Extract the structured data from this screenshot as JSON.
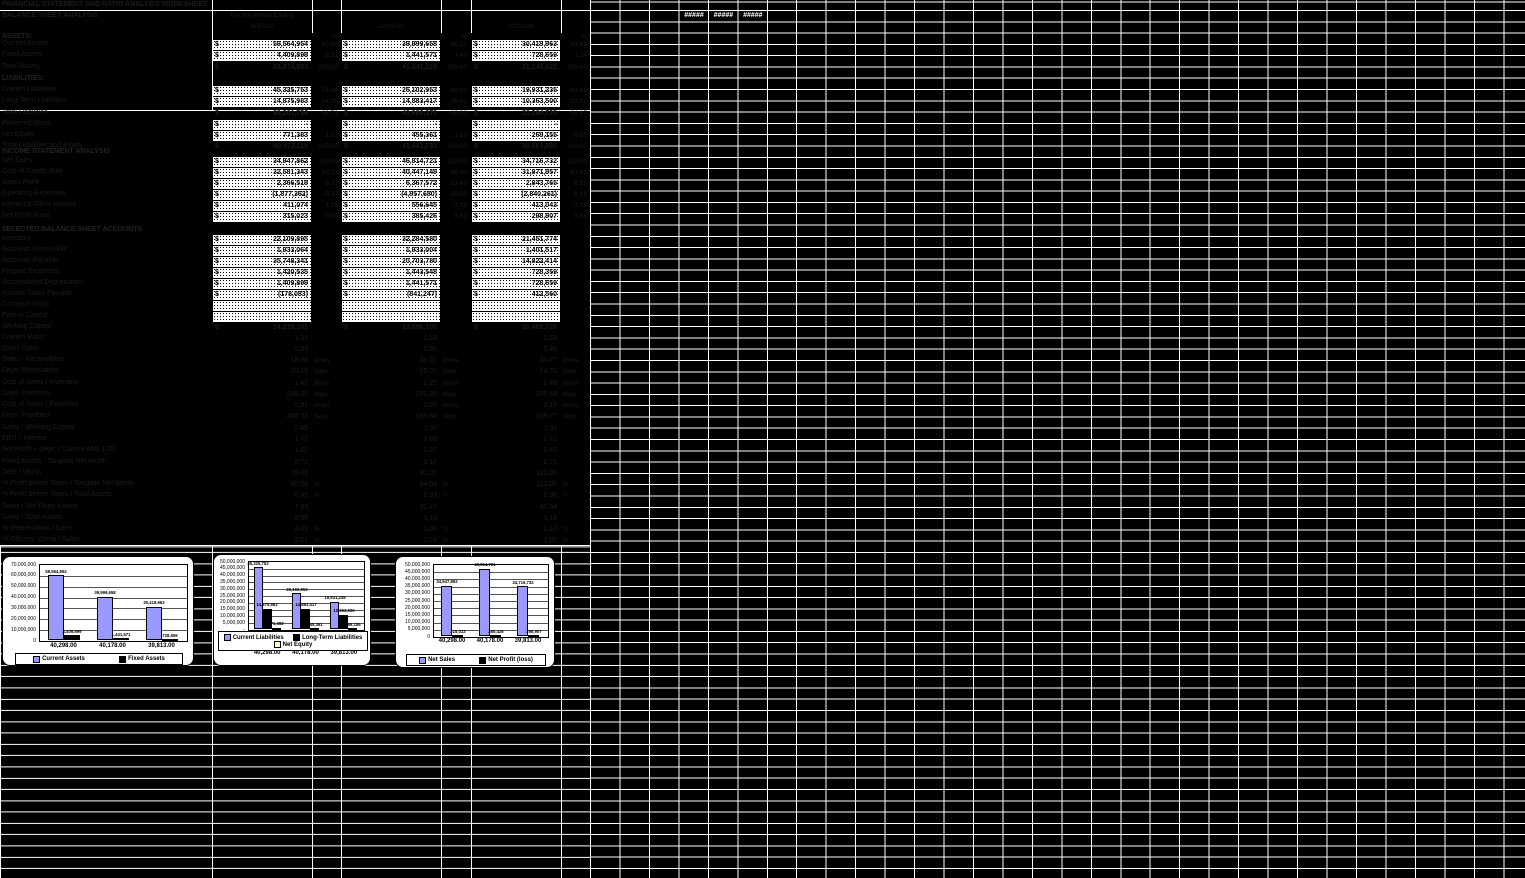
{
  "sheet": {
    "title": "FINANCIAL STATEMENT AND RATIO ANALYSIS WORKSHEET",
    "section_balance": "BALANCE SHEET ANALYSIS",
    "header": {
      "note": "For the Period Ending",
      "col_b_date": "4/30/10",
      "col_d_date": "12/31/09",
      "col_f_date": "12/31/08",
      "pct": "%"
    },
    "overflow_cells": [
      "#####",
      "#####",
      "#####"
    ],
    "rows": [
      {
        "y": 33,
        "style": "label",
        "label": "ASSETS:"
      },
      {
        "y": 40,
        "style": "white",
        "label": "Current Assets",
        "b": "59,564,954",
        "bp": "92.60",
        "d": "39,999,658",
        "dp": "96.22",
        "f": "30,419,963",
        "fp": "92.61"
      },
      {
        "y": 51,
        "style": "white",
        "label": "Fixed Assets",
        "b": "4,409,899",
        "bp": "2.31",
        "d": "1,441,571",
        "dp": "3.49",
        "f": "728,659",
        "fp": "2.24"
      },
      {
        "y": 63,
        "style": "dark$",
        "label": "Total Assets",
        "b": "63,974,853",
        "bp": "100.00",
        "d": "41,441,229",
        "dp": "100.00",
        "f": "31,148,622",
        "fp": "100.00"
      },
      {
        "y": 75,
        "style": "label",
        "label": "LIABILITIES:"
      },
      {
        "y": 86,
        "style": "white",
        "label": "Current Liabilities",
        "b": "45,325,753",
        "bp": "74.34",
        "d": "26,102,953",
        "dp": "62.09",
        "f": "19,931,235",
        "fp": "61.05"
      },
      {
        "y": 97,
        "style": "white",
        "label": "Long-Term Liabilities",
        "b": "14,875,983",
        "bp": "24.39",
        "d": "14,883,417",
        "dp": "35.91",
        "f": "10,363,500",
        "fp": "33.12"
      },
      {
        "y": 109,
        "style": "dark$",
        "label": "Total Liabilities",
        "b": "60,201,736",
        "bp": "98.73",
        "d": "40,986,370",
        "dp": "98.00",
        "f": "30,294,735",
        "fp": "94.17"
      },
      {
        "y": 120,
        "style": "white",
        "label": "Preferred Stock",
        "b": "-",
        "d": "-",
        "f": "-"
      },
      {
        "y": 131,
        "style": "white",
        "label": "Net Equity",
        "b": "771,383",
        "bp": "1.27",
        "d": "455,361",
        "dp": "1.10",
        "f": "269,155",
        "fp": "0.88"
      },
      {
        "y": 142,
        "style": "dark$",
        "label": "Total Liabilities and Equity",
        "b": "60,973,119",
        "bp": "100.00",
        "d": "41,441,731",
        "dp": "100.00",
        "f": "30,563,890",
        "fp": "100.00"
      },
      {
        "y": 148,
        "style": "header",
        "label": "INCOME STATEMENT ANALYSIS"
      },
      {
        "y": 157,
        "style": "white",
        "label": "Net Sales",
        "b": "34,947,862",
        "bp": "100.00",
        "d": "46,814,721",
        "dp": "100.00",
        "f": "34,716,732",
        "fp": "100.00"
      },
      {
        "y": 168,
        "style": "white",
        "label": "Cost of Goods Sold",
        "b": "32,581,343",
        "bp": "93.23",
        "d": "40,447,149",
        "dp": "86.40",
        "f": "31,871,957",
        "fp": "91.81"
      },
      {
        "y": 179,
        "style": "white",
        "label": "Gross Profit",
        "b": "2,366,519",
        "bp": "6.77",
        "d": "6,367,572",
        "dp": "13.60",
        "f": "2,843,765",
        "fp": "8.19"
      },
      {
        "y": 190,
        "style": "white",
        "label": "Operating Expenses",
        "b": "(1,877,362)",
        "bp": "-5.37",
        "d": "(4,957,680)",
        "dp": "-10.59",
        "f": "(2,840,261)",
        "fp": "-8.18"
      },
      {
        "y": 201,
        "style": "white",
        "label": "Interest & Other Income",
        "b": "411,074",
        "bp": "1.18",
        "d": "556,645",
        "dp": "1.19",
        "f": "413,043",
        "fp": "1.19"
      },
      {
        "y": 212,
        "style": "white",
        "label": "Net Profit (loss)",
        "b": "315,023",
        "bp": "0.90",
        "d": "385,426",
        "dp": "0.82",
        "f": "298,907",
        "fp": "0.86"
      },
      {
        "y": 226,
        "style": "header",
        "label": "SELECTED BALANCE SHEET ACCOUNTS"
      },
      {
        "y": 235,
        "style": "white",
        "label": "Inventory",
        "b": "22,109,895",
        "d": "32,284,580",
        "f": "21,451,774"
      },
      {
        "y": 246,
        "style": "white",
        "label": "Accounts Receivable",
        "b": "1,933,064",
        "d": "1,933,004",
        "f": "1,401,517"
      },
      {
        "y": 257,
        "style": "white",
        "label": "Accounts Payable",
        "b": "35,748,341",
        "d": "20,703,780",
        "f": "14,822,414"
      },
      {
        "y": 268,
        "style": "white",
        "label": "Prepaid Expenses",
        "b": "1,420,535",
        "d": "1,443,548",
        "f": "728,359"
      },
      {
        "y": 279,
        "style": "white",
        "label": "Accumulated Depreciation",
        "b": "1,409,899",
        "d": "1,441,571",
        "f": "728,659"
      },
      {
        "y": 290,
        "style": "white",
        "label": "Income Taxes Payable",
        "b": "(178,083)",
        "d": "(841,247)",
        "f": "412,560"
      },
      {
        "y": 301,
        "style": "white",
        "label": "Common Stock",
        "b": "",
        "d": "",
        "f": ""
      },
      {
        "y": 312,
        "style": "white",
        "label": "Paid-in Capital",
        "b": "",
        "d": "",
        "f": ""
      },
      {
        "y": 323,
        "style": "dark$",
        "label": "Working Capital",
        "b": "14,239,201",
        "d": "13,896,105",
        "f": "10,488,728"
      },
      {
        "y": 334,
        "style": "ratio",
        "label": "Current Ratio",
        "b": "1.31",
        "d": "1.53",
        "f": "1.53"
      },
      {
        "y": 345,
        "style": "ratio",
        "label": "Quick Ratio",
        "b": "0.83",
        "d": "0.30",
        "f": "0.45"
      },
      {
        "y": 356,
        "style": "ratio",
        "label": "Sales / Receivables",
        "b": "18.08",
        "d": "24.22",
        "f": "24.77",
        "unit": "times"
      },
      {
        "y": 367,
        "style": "ratio",
        "label": "Days' Receivables",
        "b": "20.19",
        "d": "15.07",
        "f": "14.73",
        "unit": "days"
      },
      {
        "y": 379,
        "style": "ratio",
        "label": "Cost of Sales / Inventory",
        "b": "1.47",
        "d": "1.25",
        "f": "1.49",
        "unit": "times"
      },
      {
        "y": 390,
        "style": "ratio",
        "label": "Days' Inventory",
        "b": "248.30",
        "d": "291.35",
        "f": "245.64",
        "unit": "days"
      },
      {
        "y": 401,
        "style": "ratio",
        "label": "Cost of Sales / Payables",
        "b": "0.91",
        "d": "1.95",
        "f": "2.15",
        "unit": "times"
      },
      {
        "y": 412,
        "style": "ratio",
        "label": "Days' Payables",
        "b": "400.53",
        "d": "186.84",
        "f": "169.77",
        "unit": "days"
      },
      {
        "y": 424,
        "style": "ratio",
        "label": "Sales / Working Capital",
        "b": "2.45",
        "d": "3.37",
        "f": "3.31"
      },
      {
        "y": 435,
        "style": "ratio",
        "label": "EBIT / Interest",
        "b": "1.77",
        "d": "1.69",
        "f": "1.72"
      },
      {
        "y": 446,
        "style": "ratio",
        "label": "Net Profit + Depr. / Current Mat. LTD",
        "b": "1.22",
        "d": "1.27",
        "f": "1.41"
      },
      {
        "y": 458,
        "style": "ratio",
        "label": "Fixed Assets / Tangible Net Worth",
        "b": "5.72",
        "d": "3.17",
        "f": "2.71"
      },
      {
        "y": 469,
        "style": "ratio",
        "label": "Debt / Worth",
        "b": "78.04",
        "d": "90.01",
        "f": "112.55"
      },
      {
        "y": 480,
        "style": "ratio",
        "label": "% Profit before Taxes / Tangible Net Worth",
        "b": "40.84",
        "d": "84.64",
        "f": "111.05",
        "unit": "%"
      },
      {
        "y": 491,
        "style": "ratio",
        "label": "% Profit before Taxes / Total Assets",
        "b": "0.49",
        "d": "0.93",
        "f": "0.98",
        "unit": "%"
      },
      {
        "y": 503,
        "style": "ratio",
        "label": "Sales / Net Fixed Assets",
        "b": "7.93",
        "d": "32.47",
        "f": "47.64"
      },
      {
        "y": 514,
        "style": "ratio",
        "label": "Sales / Total Assets",
        "b": "0.55",
        "d": "1.13",
        "f": "1.14"
      },
      {
        "y": 525,
        "style": "ratio",
        "label": "% Depreciation / Sales",
        "b": "4.03",
        "d": "3.08",
        "f": "2.10",
        "unit": "%"
      },
      {
        "y": 536,
        "style": "ratio",
        "label": "% Officers' Comp / Sales",
        "b": "2.21",
        "d": "1.74",
        "f": "1.85",
        "unit": "%"
      }
    ]
  },
  "charts": [
    {
      "id": "assets",
      "type": "bar",
      "title": "",
      "categories": [
        "40,298.00",
        "40,178.00",
        "39,813.00"
      ],
      "y_max": 70000000,
      "y_ticks": [
        "70,000,000",
        "60,000,000",
        "50,000,000",
        "40,000,000",
        "30,000,000",
        "20,000,000",
        "10,000,000",
        "0"
      ],
      "series": [
        {
          "name": "Current Assets",
          "color": "#9999ff",
          "values": [
            59564954,
            39999658,
            30419963
          ],
          "labels": [
            "59,564,954",
            "39,999,658",
            "30,419,963"
          ]
        },
        {
          "name": "Fixed Assets",
          "color": "#000000",
          "values": [
            4409899,
            1441571,
            728659
          ],
          "labels": [
            "4,409,899",
            "1,441,571",
            "728,659"
          ]
        }
      ],
      "legend": [
        [
          "Current Assets",
          "Fixed Assets"
        ]
      ]
    },
    {
      "id": "liabilities",
      "type": "bar",
      "title": "",
      "categories": [
        "40,298.00",
        "40,178.00",
        "39,813.00"
      ],
      "y_max": 50000000,
      "y_ticks": [
        "50,000,000",
        "45,000,000",
        "40,000,000",
        "35,000,000",
        "30,000,000",
        "25,000,000",
        "20,000,000",
        "15,000,000",
        "10,000,000",
        "5,000,000",
        "-"
      ],
      "series": [
        {
          "name": "Current Liabilities",
          "color": "#9999ff",
          "values": [
            45325753,
            26102953,
            19931235
          ],
          "labels": [
            "45,325,753",
            "26,102,953",
            "19,931,235"
          ]
        },
        {
          "name": "Long-Term Liabilities",
          "color": "#000000",
          "values": [
            14875983,
            14883417,
            10363500
          ],
          "labels": [
            "14,875,983",
            "14,883,417",
            "10,363,500"
          ]
        },
        {
          "name": "Net Equity",
          "color": "#ffffcc",
          "values": [
            771383,
            455361,
            269155
          ],
          "labels": [
            "771,383",
            "455,361",
            "269,155"
          ]
        }
      ],
      "legend": [
        [
          "Current Liabilities",
          "Long-Term Liabilities"
        ],
        [
          "Net Equity"
        ]
      ]
    },
    {
      "id": "sales",
      "type": "bar",
      "title": "",
      "categories": [
        "40,298.00",
        "40,178.00",
        "39,813.00"
      ],
      "y_max": 50000000,
      "y_ticks": [
        "50,000,000",
        "45,000,000",
        "40,000,000",
        "35,000,000",
        "30,000,000",
        "25,000,000",
        "20,000,000",
        "15,000,000",
        "10,000,000",
        "5,000,000",
        "0"
      ],
      "series": [
        {
          "name": "Net Sales",
          "color": "#9999ff",
          "values": [
            34947862,
            46814721,
            34716732
          ],
          "labels": [
            "34,947,862",
            "46,814,721",
            "34,716,732"
          ]
        },
        {
          "name": "Net Profit (loss)",
          "color": "#000000",
          "values": [
            315023,
            385426,
            298907
          ],
          "labels": [
            "315,023",
            "385,426",
            "298,907"
          ]
        }
      ],
      "legend": [
        [
          "Net Sales",
          "Net Profit (loss)"
        ]
      ]
    }
  ]
}
